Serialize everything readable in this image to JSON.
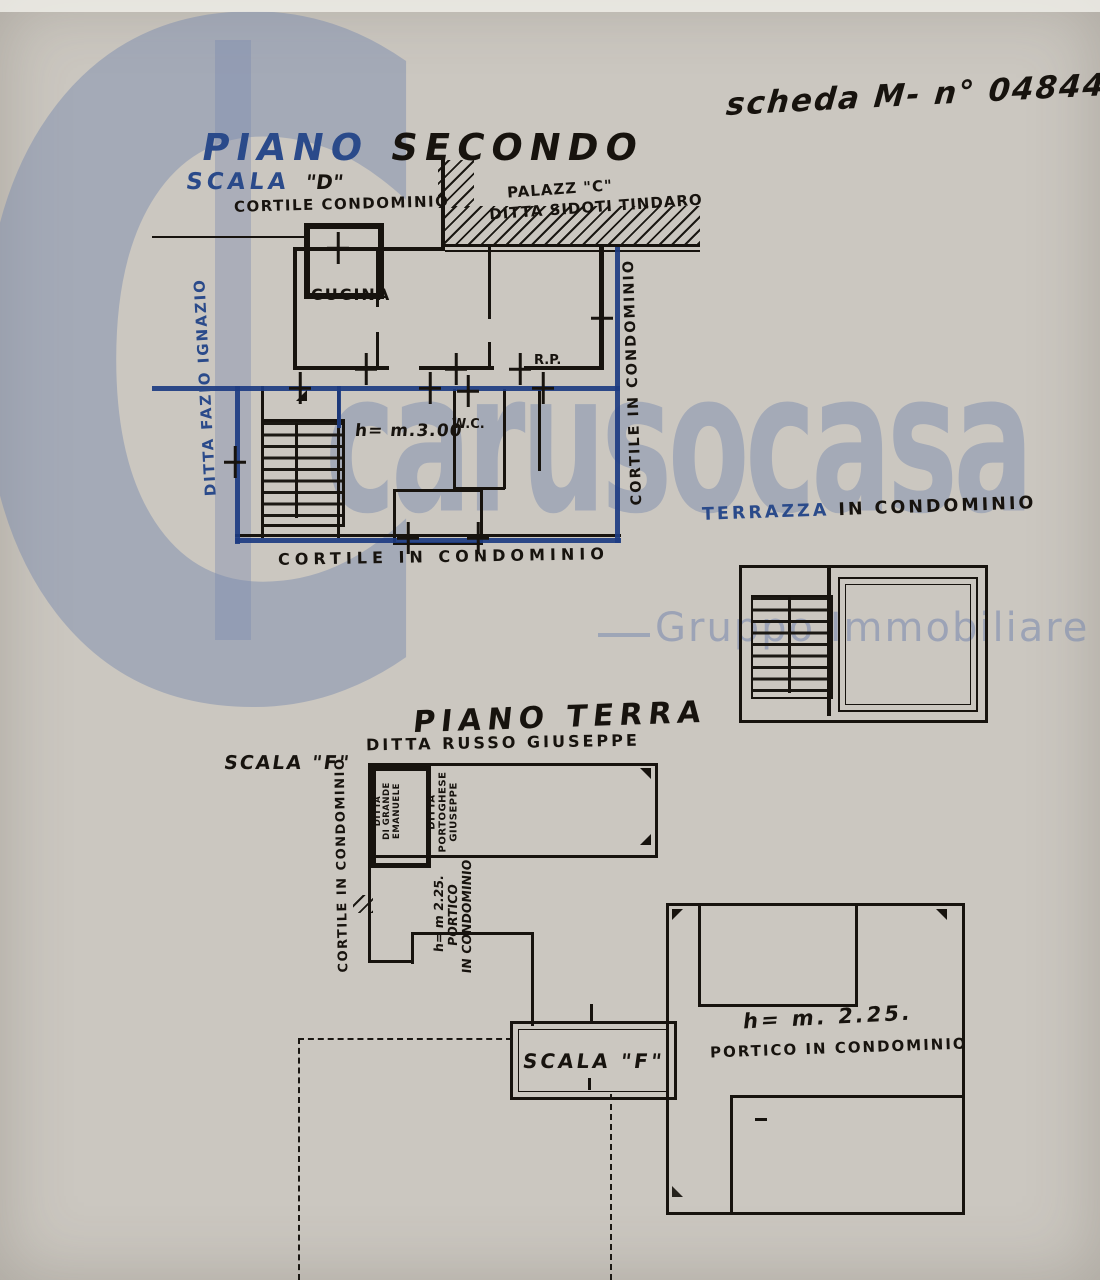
{
  "note": {
    "sheet": "scheda M- n° 04844"
  },
  "watermark": {
    "letter": "C",
    "brand": "carusocasa",
    "company": "Gruppo Immobiliare s.r.l."
  },
  "colors": {
    "paper": "#cbc7c0",
    "ink": "#17130e",
    "blue_ink": "#2a4a8a",
    "highlight_blue": "#1d3c82",
    "watermark_blue": "#7a8aae"
  },
  "second_floor": {
    "title_blue": "PIANO",
    "title_black": "SECONDO",
    "scala_word": "SCALA",
    "scala_name": "\"D\"",
    "cortile_top": "CORTILE CONDOMINIO",
    "palazzo_line1": "PALAZZ \"C\"",
    "palazzo_line2": "DITTA SIDOTI TINDARO",
    "ditta_left": "DITTA FAZIO IGNAZIO",
    "cortile_right": "CORTILE IN CONDOMINIO",
    "room_kitchen": "CUCINA",
    "height_note": "h= m.3.00",
    "room_wc": "W.C.",
    "room_rp": "R.P.",
    "cortile_bottom": "CORTILE IN CONDOMINIO",
    "terrazza_blue": "TERRAZZA",
    "terrazza_black": "IN CONDOMINIO"
  },
  "ground_floor": {
    "title": "PIANO TERRA",
    "subtitle": "DITTA RUSSO GIUSEPPE",
    "scala_label": "SCALA \"F\"",
    "cortile_left": "CORTILE IN CONDOMINIO",
    "box_owner_l1": "DITTA",
    "box_owner_l2": "DI GRANDE",
    "box_owner_l3": "EMANUELE",
    "portoghese_l1": "DITTA",
    "portoghese_l2": "PORTOGHESE",
    "portoghese_l3": "GIUSEPPE",
    "portico_left_l1": "h= m 2.25.",
    "portico_left_l2": "PORTICO",
    "portico_left_l3": "IN CONDOMINIO",
    "scala_box": "SCALA \"F\"",
    "portico_right_h": "h= m. 2.25.",
    "portico_right": "PORTICO IN CONDOMINIO"
  }
}
